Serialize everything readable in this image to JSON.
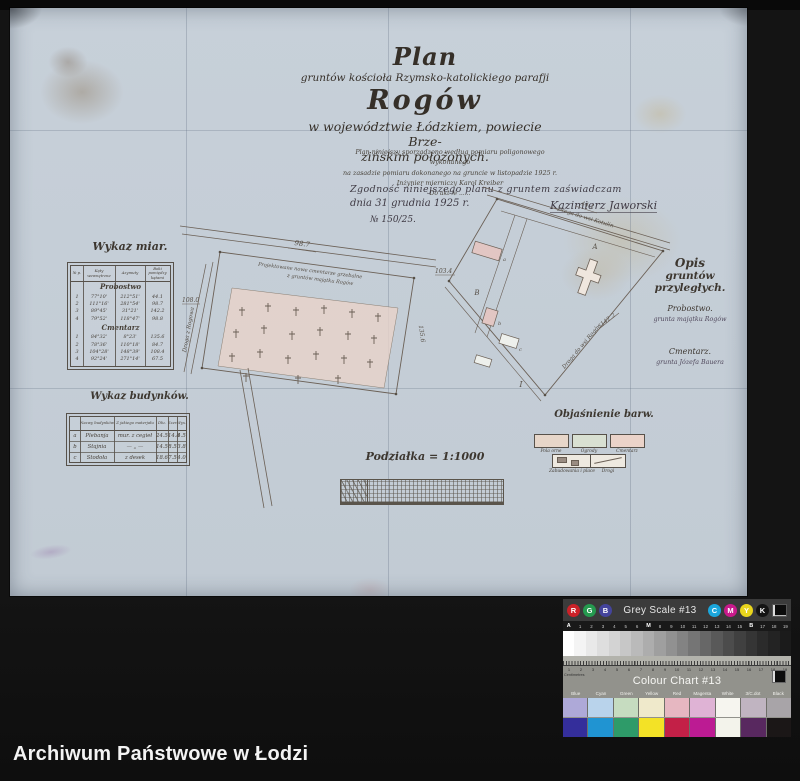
{
  "photo": {
    "archive_caption": "Archiwum Państwowe w Łodzi"
  },
  "title_block": {
    "plan": "Plan",
    "line2": "gruntów kościoła Rzymsko-katolickiego parafji",
    "name": "Rogów",
    "line4": "w województwie Łódzkiem, powiecie Brze-",
    "line5": "zińskim położonych.",
    "notes": [
      "Plan niniejszy sporządzono według pomiaru poligonowego wykonanego",
      "na zasadzie pomiaru dokonanego na gruncie w listopadzie 1925 r.",
      "Inżynier mierniczy Karol Kreiber",
      "Do akt № ......"
    ],
    "attest_line1": "Zgodność niniejszego planu z gruntem zaświadczam",
    "attest_date": "dnia 31 grudnia 1925 r.",
    "attest_signature": "Kazimierz Jaworski",
    "attest_number": "№ 150/25."
  },
  "measures_table": {
    "title": "Wykaz miar.",
    "columns": [
      "№ p.",
      "Kąty wewnętrzne",
      "Azymuty",
      "Boki pomiędzy kątami"
    ],
    "sections": [
      {
        "name": "Probostwo",
        "rows": [
          [
            "1",
            "77°10'",
            "212°51'",
            "44.1"
          ],
          [
            "2",
            "111°16'",
            "281°54'",
            "98.7"
          ],
          [
            "3",
            "89°45'",
            "31°21'",
            "142.2"
          ],
          [
            "4",
            "79°52'",
            "118°47'",
            "98.8"
          ]
        ]
      },
      {
        "name": "Cmentarz",
        "rows": [
          [
            "1",
            "84°32'",
            "8°23'",
            "135.6"
          ],
          [
            "2",
            "78°36'",
            "110°18'",
            "84.7"
          ],
          [
            "3",
            "104°28'",
            "148°39'",
            "108.4"
          ],
          [
            "4",
            "92°24'",
            "271°14'",
            "67.5"
          ]
        ]
      }
    ]
  },
  "buildings_table": {
    "title": "Wykaz budynków.",
    "columns": [
      "",
      "Nazwy budynków",
      "Z jakiego materjału",
      "Dłu.",
      "Szer.",
      "Wys."
    ],
    "rows": [
      [
        "a",
        "Plebanja",
        "mur. z cegieł",
        "24.5",
        "14.8",
        "4.5"
      ],
      [
        "b",
        "Stajnia",
        "— „ —",
        "14.5",
        "8.5",
        "3.8"
      ],
      [
        "c",
        "Stodoła",
        "z desek",
        "18.6",
        "7.5",
        "4.0"
      ]
    ]
  },
  "adjacent_block": {
    "title_line1": "Opis",
    "title_line2": "gruntów przyległych.",
    "item1_name": "Probostwo.",
    "item1_text": "grunta majątku Rogów",
    "item2_name": "Cmentarz.",
    "item2_text": "grunta Józefa Bauera"
  },
  "legend": {
    "title": "Objaśnienie barw.",
    "swatches": [
      {
        "label": "Pola orne",
        "color": "#e7d6c9"
      },
      {
        "label": "Ogrody",
        "color": "#d9e0d2"
      },
      {
        "label": "Cmentarz",
        "color": "#ebd3c9"
      },
      {
        "label": "Zabudowania i place",
        "color": "#eee9e0"
      },
      {
        "label": "Drogi",
        "color": "#eee9e0"
      }
    ]
  },
  "scale": {
    "label": "Podziałka = 1:1000"
  },
  "cemetery_parcel": {
    "note_line1": "Projektowane nowe cmentarze grzebalne",
    "note_line2": "z gruntów majątku Rogów",
    "edge_top": "98.7",
    "edge_left": "108.0",
    "edge_right": "135.6",
    "road_left_label": "Droga z Rogowa"
  },
  "parsonage_parcel": {
    "edge_top": "44.1",
    "edge_left": "103.4",
    "edge_bottom": "142.2",
    "road_top_label": "Droga do wsi Kotulin",
    "road_bottom_label": "Droga do wsi Rogów",
    "region_labels": [
      "A",
      "B",
      "I"
    ],
    "building_labels": [
      "a",
      "b",
      "c"
    ]
  },
  "grey_card": {
    "title": "Grey Scale #13",
    "rgb": [
      "R",
      "G",
      "B"
    ],
    "rgb_colors": [
      "#cb2128",
      "#259a4f",
      "#44449c"
    ],
    "cmyk": [
      "C",
      "M",
      "Y",
      "K"
    ],
    "cmyk_colors": [
      "#1ba6db",
      "#c81a8b",
      "#e9d51d",
      "#141414"
    ],
    "scale_labels": [
      "A",
      "1",
      "2",
      "3",
      "4",
      "5",
      "6",
      "M",
      "8",
      "9",
      "10",
      "11",
      "12",
      "13",
      "14",
      "15",
      "B",
      "17",
      "18",
      "19"
    ],
    "steps": [
      "#ffffff",
      "#f4f4f4",
      "#e9e9e9",
      "#dedede",
      "#d3d3d3",
      "#c7c7c7",
      "#bababa",
      "#adadad",
      "#9f9f9f",
      "#919191",
      "#838383",
      "#757575",
      "#676767",
      "#595959",
      "#4c4c4c",
      "#404040",
      "#353535",
      "#2b2b2b",
      "#232323",
      "#1b1b1b"
    ]
  },
  "colour_card": {
    "title": "Colour Chart #13",
    "ruler_label": "Centimetres",
    "ruler_numbers": [
      "1",
      "2",
      "3",
      "4",
      "5",
      "6",
      "7",
      "8",
      "9",
      "10",
      "11",
      "12",
      "13",
      "14",
      "15",
      "16",
      "17",
      "18",
      "19"
    ],
    "columns": [
      "Blue",
      "Cyan",
      "Green",
      "Yellow",
      "Red",
      "Magenta",
      "White",
      "3/C.dot",
      "Black"
    ],
    "pastel": [
      "#aea9d8",
      "#b9d3eb",
      "#c6dcc0",
      "#efe9cb",
      "#e6b7c1",
      "#dfb3d5",
      "#f6f5ef",
      "#c0b4c1",
      "#a8a4a8"
    ],
    "solid": [
      "#342e9b",
      "#2094d2",
      "#2e9b69",
      "#f3e226",
      "#c32047",
      "#bc1b93",
      "#f3f3eb",
      "#58285f",
      "#1b1717"
    ]
  }
}
